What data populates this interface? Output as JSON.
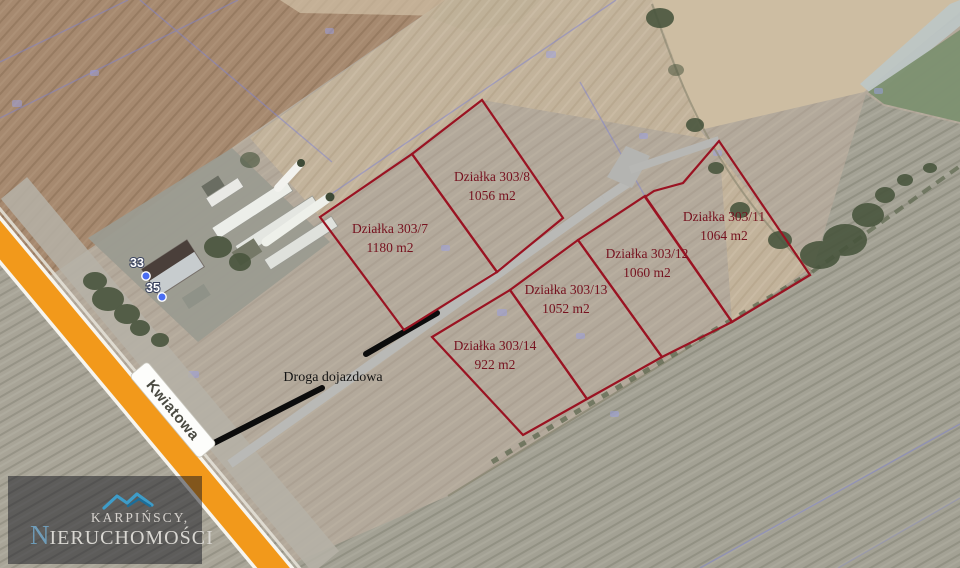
{
  "map": {
    "street_label": "Kwiatowa",
    "access_road_label": "Droga dojazdowa",
    "address_markers": {
      "m33": "33",
      "m35": "35"
    },
    "parcels": [
      {
        "name": "Działka 303/7",
        "area": "1180 m2"
      },
      {
        "name": "Działka 303/8",
        "area": "1056 m2"
      },
      {
        "name": "Działka 303/11",
        "area": "1064 m2"
      },
      {
        "name": "Działka 303/12",
        "area": "1060 m2"
      },
      {
        "name": "Działka 303/13",
        "area": "1052 m2"
      },
      {
        "name": "Działka 303/14",
        "area": "922 m2"
      }
    ],
    "colors": {
      "parcel_outline": "#9a1322",
      "parcel_label": "#76121f",
      "street_fill": "#f2991b",
      "access_road": "#b9b9b6",
      "proposed_drive": "#0c0c0c",
      "marker_dot": "#4a6df2",
      "cadastral_line": "#7e82d2"
    }
  },
  "logo": {
    "line1": "KARPIŃSCY,",
    "initial": "N",
    "rest": "IERUCHOMOŚCI"
  }
}
